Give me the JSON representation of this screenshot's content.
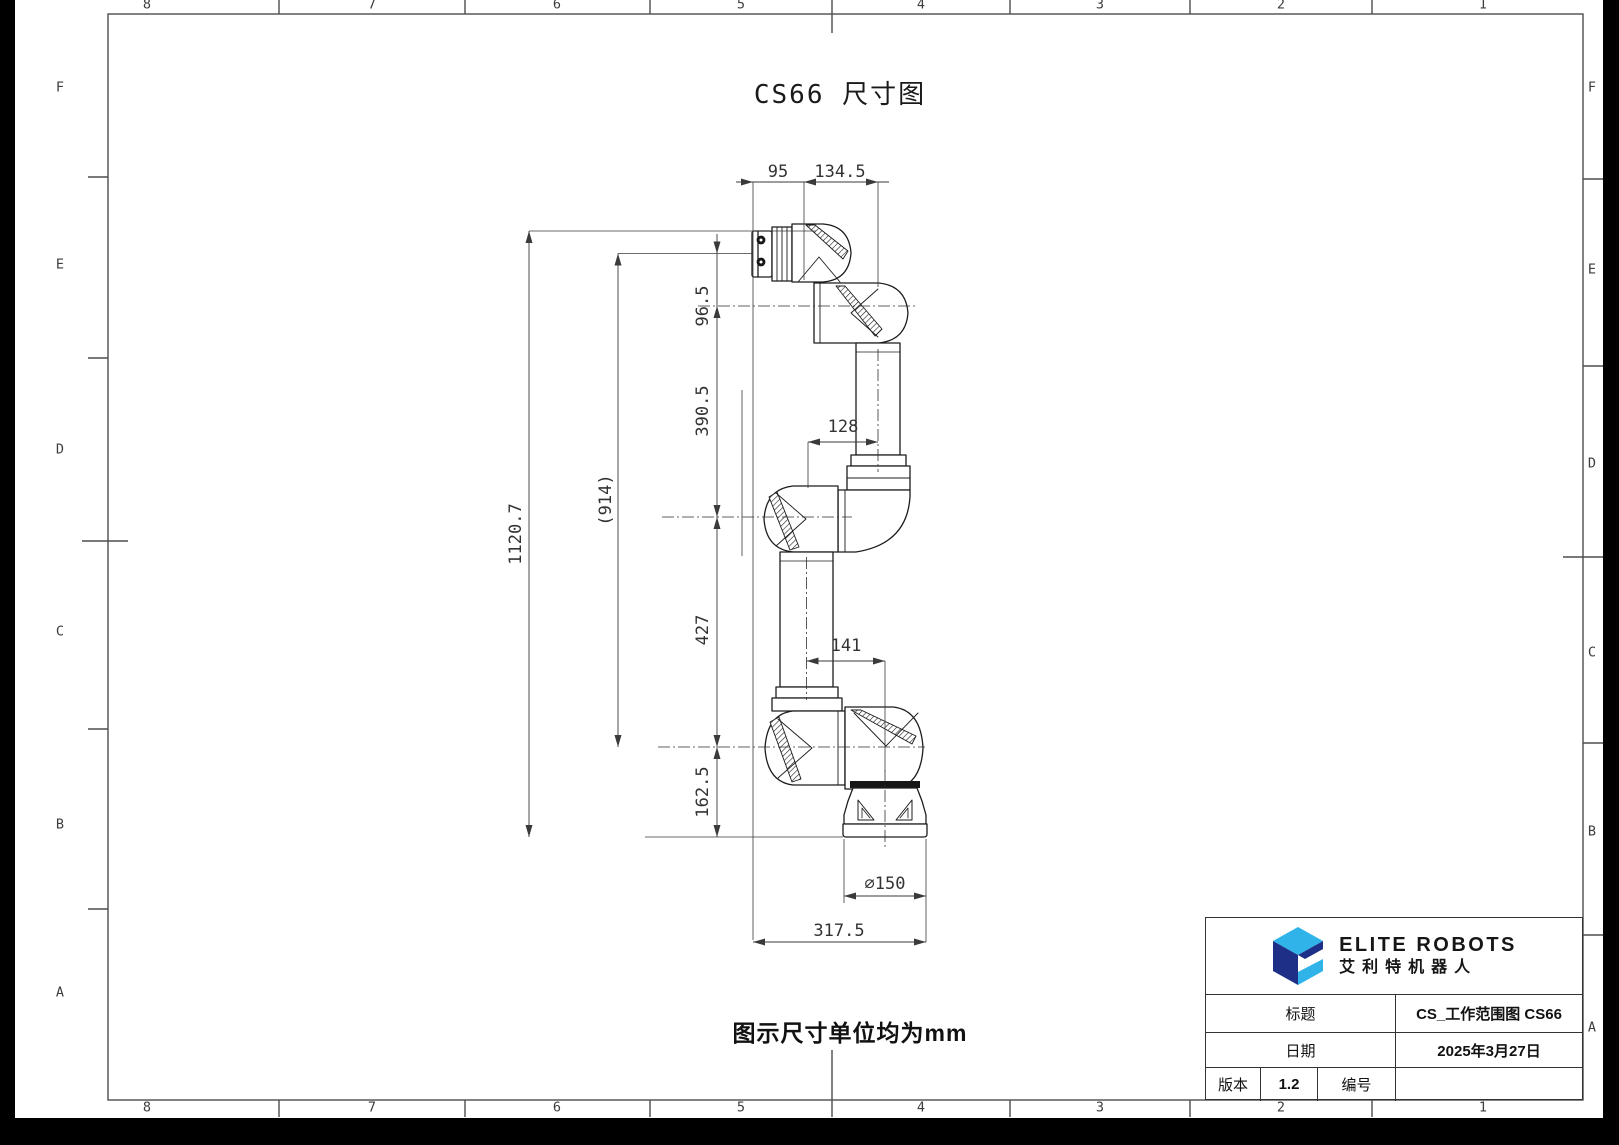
{
  "drawing": {
    "title": "CS66 尺寸图",
    "unit_note": "图示尺寸单位均为mm"
  },
  "frame": {
    "columns": [
      "8",
      "7",
      "6",
      "5",
      "4",
      "3",
      "2",
      "1"
    ],
    "rows": [
      "F",
      "E",
      "D",
      "C",
      "B",
      "A"
    ]
  },
  "dims": {
    "d95": "95",
    "d134_5": "134.5",
    "d96_5": "96.5",
    "d390_5": "390.5",
    "d427": "427",
    "d162_5": "162.5",
    "d1120_7": "1120.7",
    "d914": "(914)",
    "d128": "128",
    "d141": "141",
    "d150": "⌀150",
    "d317_5": "317.5"
  },
  "title_block": {
    "brand_en": "ELITE ROBOTS",
    "brand_cn": "艾利特机器人",
    "title_label": "标题",
    "title_value": "CS_工作范围图 CS66",
    "date_label": "日期",
    "date_value": "2025年3月27日",
    "version_label": "版本",
    "version_value": "1.2",
    "number_label": "编号",
    "number_value": ""
  },
  "colors": {
    "brand_navy": "#1d2f87",
    "brand_blue": "#2fb3e8"
  }
}
